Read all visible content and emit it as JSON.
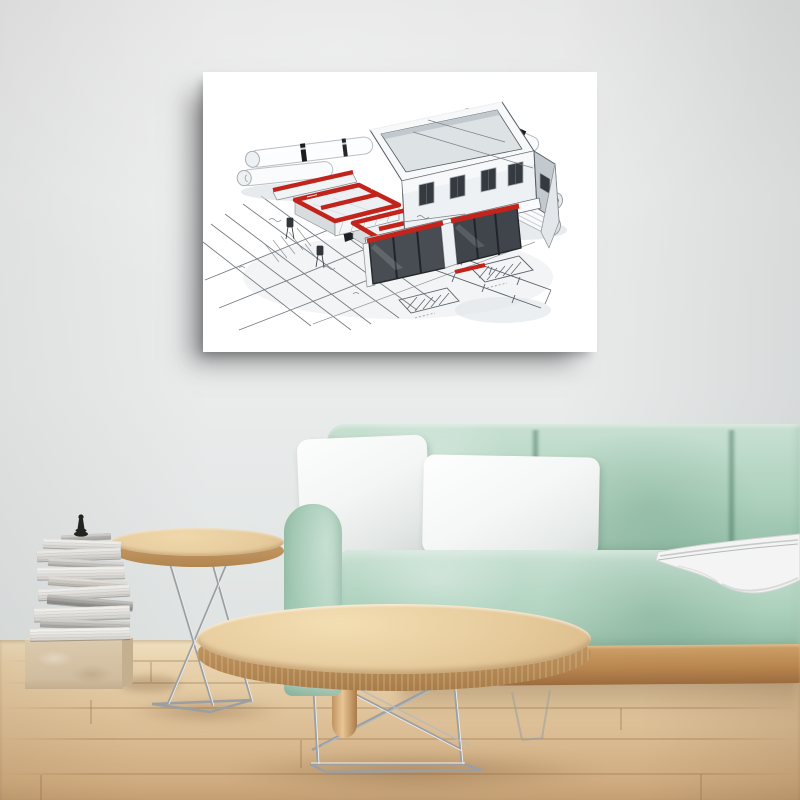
{
  "meta": {
    "description": "Product photo of a rectangular white canvas wall art print showing a 3D architectural model of a house with red-topped cutaway walls, rolled blueprints and hand-drawn site-plan sketches. The canvas hangs on a pale grey wall above a mint green velvet sofa with two white pillows and a white throw blanket. In front stand an oval light-wood coffee table and a round side table, both with chrome wire legs, on a light wooden plank floor. At the left, a stack of books topped with a dark chess piece rests on a travertine stone block."
  },
  "labels": {
    "artwork": "architecture house blueprint canvas print",
    "sofa": "mint green velvet sofa",
    "pillow_square": "white square pillow",
    "pillow_lumbar": "white lumbar pillow",
    "blanket": "white throw blanket",
    "coffee_table": "oval wood coffee table with chrome wire legs",
    "side_table": "round wood side table with chrome tripod legs",
    "books": "stack of books on stone block",
    "chess_piece": "dark chess piece",
    "floor": "light wood plank floor",
    "wall": "pale grey wall"
  },
  "palette": {
    "wall": "#eaecec",
    "canvas": "#ffffff",
    "art_accent": "#c2231b",
    "art_line": "#565c61",
    "art_shade": "#ccd2d6",
    "floor_light": "#f0e0bf",
    "floor_mid": "#e2c8a0",
    "floor_dark": "#d0ac80",
    "sofa_light": "#c8e0d2",
    "sofa_mid": "#aed2be",
    "sofa_dark": "#92bca6",
    "pillow": "#f5f6f5",
    "throw": "#f3f4f3",
    "wood_rail": "#cfa169",
    "wood_rail_dark": "#9c6c3e",
    "table_top": "#e6cb9c",
    "table_edge": "#bb8e58",
    "chrome": "#9b9fa2",
    "chrome_light": "#f4f6f6",
    "stone_top": "#e9dac0",
    "stone_front": "#dccaae",
    "stone_side": "#c4b08e",
    "chess": "#20261f"
  },
  "books": [
    {
      "w": 50,
      "h": 6,
      "dx": 4,
      "rot": -3,
      "color": "#b3b1ac"
    },
    {
      "w": 78,
      "h": 9,
      "dx": 0,
      "rot": 2,
      "color": "#e9e6e0"
    },
    {
      "w": 84,
      "h": 11,
      "dx": -3,
      "rot": -2,
      "color": "#dfdcd6"
    },
    {
      "w": 76,
      "h": 7,
      "dx": 4,
      "rot": 3,
      "color": "#c3c0ba"
    },
    {
      "w": 88,
      "h": 12,
      "dx": -1,
      "rot": -1,
      "color": "#eae7e1"
    },
    {
      "w": 80,
      "h": 8,
      "dx": 6,
      "rot": 4,
      "color": "#cfc9bf"
    },
    {
      "w": 92,
      "h": 11,
      "dx": 2,
      "rot": -3,
      "color": "#e6e3dd"
    },
    {
      "w": 86,
      "h": 9,
      "dx": 8,
      "rot": 5,
      "color": "#8f8d88"
    },
    {
      "w": 96,
      "h": 13,
      "dx": 0,
      "rot": -2,
      "color": "#e8e5df"
    },
    {
      "w": 90,
      "h": 8,
      "dx": 3,
      "rot": 2,
      "color": "#b5b2ac"
    },
    {
      "w": 100,
      "h": 12,
      "dx": -2,
      "rot": -1,
      "color": "#eceae4"
    }
  ]
}
